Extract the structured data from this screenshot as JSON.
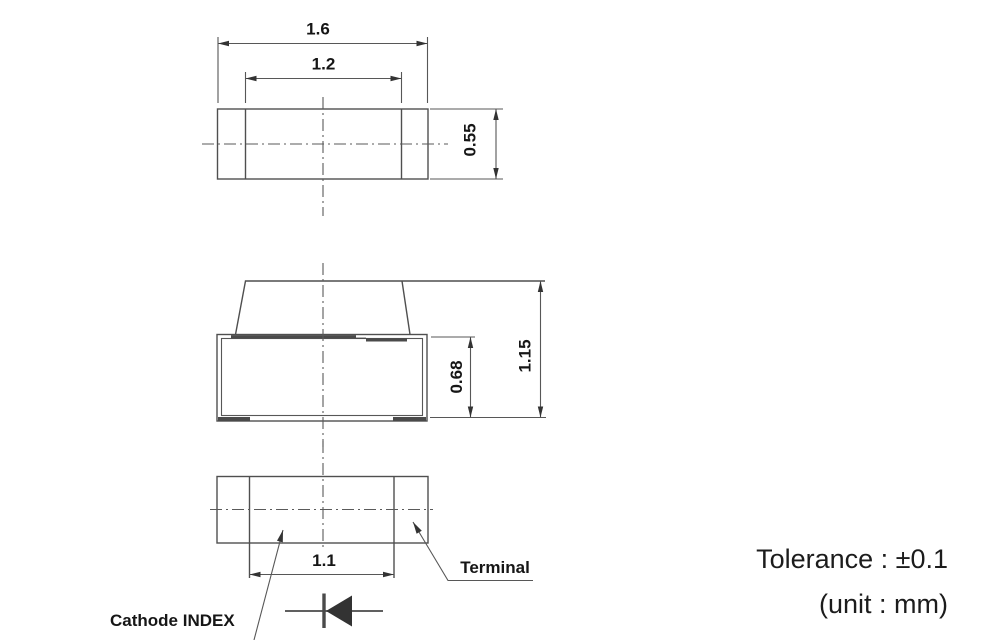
{
  "drawing": {
    "top_view": {
      "dim_overall_width": "1.6",
      "dim_inner_width": "1.2",
      "dim_depth": "0.55"
    },
    "side_view": {
      "dim_body_height": "0.68",
      "dim_total_height": "1.15"
    },
    "bottom_view": {
      "dim_terminal_span": "1.1",
      "label_terminal": "Terminal",
      "label_cathode_index": "Cathode INDEX"
    },
    "notes": {
      "tolerance": "Tolerance : ±0.1",
      "unit": "(unit : mm)"
    },
    "colors": {
      "line": "#4f4f4f",
      "label": "#161616",
      "note_text": "#1c1c1c",
      "background": "#ffffff"
    }
  }
}
